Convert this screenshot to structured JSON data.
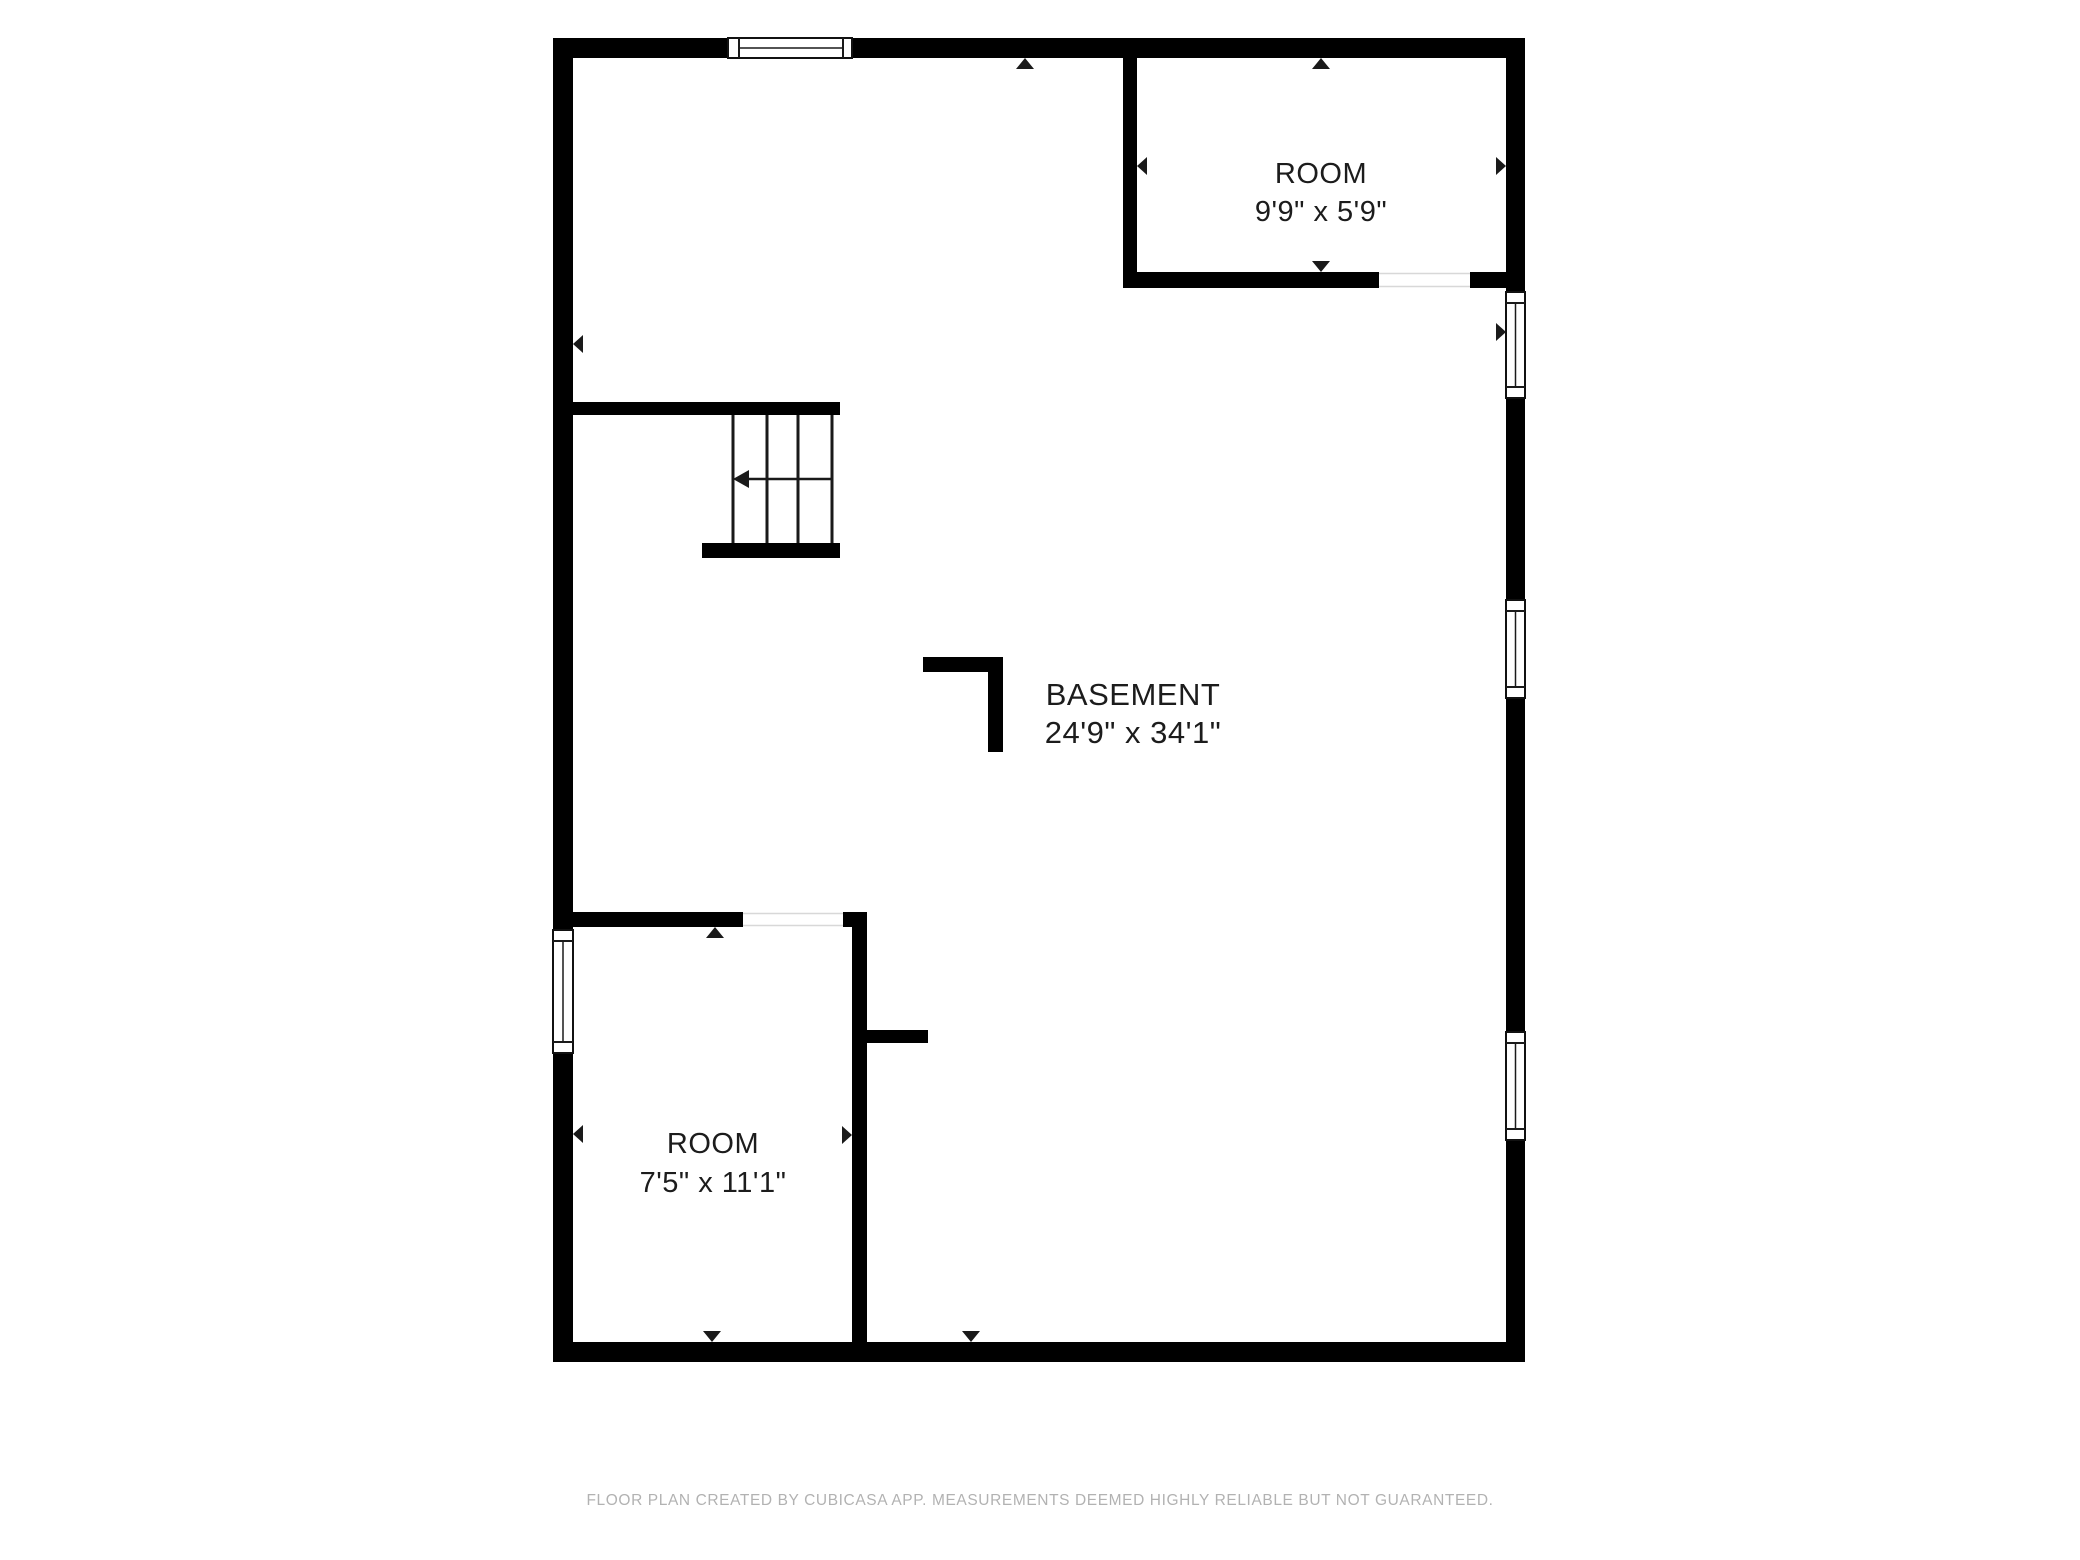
{
  "canvas": {
    "width": 2080,
    "height": 1560,
    "background": "#ffffff"
  },
  "plan": {
    "wall_color": "#000000",
    "line_color": "#1a1a1a",
    "text_color": "#1c1c1c",
    "opening_edge_color": "#d8d8d8",
    "rooms": [
      {
        "label": "ROOM",
        "dimensions": "9'9\" x 5'9\""
      },
      {
        "label": "BASEMENT",
        "dimensions": "24'9\" x 34'1\""
      },
      {
        "label": "ROOM",
        "dimensions": "7'5\" x 11'1\""
      }
    ],
    "shapes": [
      {
        "type": "rect",
        "x": 553,
        "y": 38,
        "w": 175,
        "h": 20,
        "name": "wall-top-left-segment"
      },
      {
        "type": "rect",
        "x": 852,
        "y": 38,
        "w": 673,
        "h": 20,
        "name": "wall-top-right-segment"
      },
      {
        "type": "rect",
        "x": 553,
        "y": 58,
        "w": 20,
        "h": 872,
        "name": "wall-left-upper-segment"
      },
      {
        "type": "rect",
        "x": 553,
        "y": 1053,
        "w": 20,
        "h": 309,
        "name": "wall-left-lower-segment"
      },
      {
        "type": "rect",
        "x": 1506,
        "y": 58,
        "w": 19,
        "h": 234,
        "name": "wall-right-segment-1"
      },
      {
        "type": "rect",
        "x": 1506,
        "y": 398,
        "w": 19,
        "h": 202,
        "name": "wall-right-segment-2"
      },
      {
        "type": "rect",
        "x": 1506,
        "y": 698,
        "w": 19,
        "h": 334,
        "name": "wall-right-segment-3"
      },
      {
        "type": "rect",
        "x": 1506,
        "y": 1140,
        "w": 19,
        "h": 222,
        "name": "wall-right-segment-4"
      },
      {
        "type": "rect",
        "x": 553,
        "y": 1342,
        "w": 972,
        "h": 20,
        "name": "wall-bottom"
      },
      {
        "type": "rect",
        "x": 573,
        "y": 402,
        "w": 267,
        "h": 13,
        "name": "wall-stair-header"
      },
      {
        "type": "rect",
        "x": 702,
        "y": 543,
        "w": 138,
        "h": 15,
        "name": "stair-base-wall"
      },
      {
        "type": "rect",
        "x": 573,
        "y": 912,
        "w": 170,
        "h": 15,
        "name": "wall-room1-top"
      },
      {
        "type": "rect",
        "x": 843,
        "y": 912,
        "w": 24,
        "h": 15,
        "name": "wall-room1-top-corner"
      },
      {
        "type": "rect",
        "x": 852,
        "y": 927,
        "w": 15,
        "h": 415,
        "name": "wall-room1-right"
      },
      {
        "type": "rect",
        "x": 867,
        "y": 1030,
        "w": 61,
        "h": 13,
        "name": "wall-stub"
      },
      {
        "type": "rect",
        "x": 1123,
        "y": 57,
        "w": 14,
        "h": 215,
        "name": "wall-room2-left"
      },
      {
        "type": "rect",
        "x": 1123,
        "y": 272,
        "w": 256,
        "h": 16,
        "name": "wall-room2-bottom-left-segment"
      },
      {
        "type": "rect",
        "x": 1470,
        "y": 272,
        "w": 36,
        "h": 16,
        "name": "wall-room2-bottom-right-segment"
      },
      {
        "type": "rect",
        "x": 923,
        "y": 657,
        "w": 80,
        "h": 15,
        "name": "corner-marker-horizontal"
      },
      {
        "type": "rect",
        "x": 988,
        "y": 657,
        "w": 15,
        "h": 95,
        "name": "corner-marker-vertical"
      },
      {
        "type": "rect",
        "x": 743,
        "y": 912,
        "w": 100,
        "h": 15,
        "fill": "#ffffff",
        "name": "doorway-opening"
      },
      {
        "type": "line",
        "x1": 743,
        "y1": 913.5,
        "x2": 843,
        "y2": 913.5,
        "sw": 1.5,
        "color": "#d8d8d8",
        "name": "doorway-opening-edge"
      },
      {
        "type": "line",
        "x1": 743,
        "y1": 925.5,
        "x2": 843,
        "y2": 925.5,
        "sw": 1.5,
        "color": "#d8d8d8",
        "name": "doorway-opening-edge"
      },
      {
        "type": "rect",
        "x": 1379,
        "y": 272,
        "w": 91,
        "h": 16,
        "fill": "#ffffff",
        "name": "doorway-opening"
      },
      {
        "type": "line",
        "x1": 1379,
        "y1": 273.5,
        "x2": 1470,
        "y2": 273.5,
        "sw": 1.5,
        "color": "#d8d8d8",
        "name": "doorway-opening-edge"
      },
      {
        "type": "line",
        "x1": 1379,
        "y1": 286.5,
        "x2": 1470,
        "y2": 286.5,
        "sw": 1.5,
        "color": "#d8d8d8",
        "name": "doorway-opening-edge"
      },
      {
        "type": "rect",
        "x": 728,
        "y": 38,
        "w": 124,
        "h": 20,
        "fill": "#ffffff",
        "stroke": "#111111",
        "sw": 2,
        "name": "window-frame"
      },
      {
        "type": "line",
        "x1": 739,
        "y1": 38,
        "x2": 739,
        "y2": 58,
        "sw": 2,
        "name": "window-frame-line"
      },
      {
        "type": "line",
        "x1": 843,
        "y1": 38,
        "x2": 843,
        "y2": 58,
        "sw": 2,
        "name": "window-frame-line"
      },
      {
        "type": "line",
        "x1": 739,
        "y1": 48,
        "x2": 843,
        "y2": 48,
        "sw": 1.5,
        "name": "window-pane-line"
      },
      {
        "type": "rect",
        "x": 553,
        "y": 930,
        "w": 20,
        "h": 123,
        "fill": "#ffffff",
        "stroke": "#111111",
        "sw": 2,
        "name": "window-frame"
      },
      {
        "type": "line",
        "x1": 553,
        "y1": 941,
        "x2": 573,
        "y2": 941,
        "sw": 2,
        "name": "window-frame-line"
      },
      {
        "type": "line",
        "x1": 553,
        "y1": 1042,
        "x2": 573,
        "y2": 1042,
        "sw": 2,
        "name": "window-frame-line"
      },
      {
        "type": "line",
        "x1": 563,
        "y1": 941,
        "x2": 563,
        "y2": 1042,
        "sw": 1.5,
        "name": "window-pane-line"
      },
      {
        "type": "rect",
        "x": 1506,
        "y": 292,
        "w": 19,
        "h": 106,
        "fill": "#ffffff",
        "stroke": "#111111",
        "sw": 2,
        "name": "window-frame"
      },
      {
        "type": "line",
        "x1": 1506,
        "y1": 303,
        "x2": 1525,
        "y2": 303,
        "sw": 2,
        "name": "window-frame-line"
      },
      {
        "type": "line",
        "x1": 1506,
        "y1": 387,
        "x2": 1525,
        "y2": 387,
        "sw": 2,
        "name": "window-frame-line"
      },
      {
        "type": "line",
        "x1": 1515.5,
        "y1": 303,
        "x2": 1515.5,
        "y2": 387,
        "sw": 1.5,
        "name": "window-pane-line"
      },
      {
        "type": "rect",
        "x": 1506,
        "y": 600,
        "w": 19,
        "h": 98,
        "fill": "#ffffff",
        "stroke": "#111111",
        "sw": 2,
        "name": "window-frame"
      },
      {
        "type": "line",
        "x1": 1506,
        "y1": 611,
        "x2": 1525,
        "y2": 611,
        "sw": 2,
        "name": "window-frame-line"
      },
      {
        "type": "line",
        "x1": 1506,
        "y1": 687,
        "x2": 1525,
        "y2": 687,
        "sw": 2,
        "name": "window-frame-line"
      },
      {
        "type": "line",
        "x1": 1515.5,
        "y1": 611,
        "x2": 1515.5,
        "y2": 687,
        "sw": 1.5,
        "name": "window-pane-line"
      },
      {
        "type": "rect",
        "x": 1506,
        "y": 1032,
        "w": 19,
        "h": 108,
        "fill": "#ffffff",
        "stroke": "#111111",
        "sw": 2,
        "name": "window-frame"
      },
      {
        "type": "line",
        "x1": 1506,
        "y1": 1043,
        "x2": 1525,
        "y2": 1043,
        "sw": 2,
        "name": "window-frame-line"
      },
      {
        "type": "line",
        "x1": 1506,
        "y1": 1129,
        "x2": 1525,
        "y2": 1129,
        "sw": 2,
        "name": "window-frame-line"
      },
      {
        "type": "line",
        "x1": 1515.5,
        "y1": 1043,
        "x2": 1515.5,
        "y2": 1129,
        "sw": 1.5,
        "name": "window-pane-line"
      },
      {
        "type": "line",
        "x1": 733,
        "y1": 415,
        "x2": 733,
        "y2": 543,
        "sw": 3,
        "name": "stair-tread-line"
      },
      {
        "type": "line",
        "x1": 767,
        "y1": 415,
        "x2": 767,
        "y2": 543,
        "sw": 3,
        "name": "stair-tread-line"
      },
      {
        "type": "line",
        "x1": 798,
        "y1": 415,
        "x2": 798,
        "y2": 543,
        "sw": 3,
        "name": "stair-tread-line"
      },
      {
        "type": "line",
        "x1": 832,
        "y1": 415,
        "x2": 832,
        "y2": 543,
        "sw": 3,
        "name": "stair-tread-line"
      },
      {
        "type": "line",
        "x1": 747,
        "y1": 479,
        "x2": 832,
        "y2": 479,
        "sw": 2.5,
        "name": "stair-arrow-line"
      },
      {
        "type": "poly",
        "points": [
          [
            733,
            479
          ],
          [
            749,
            470
          ],
          [
            749,
            488
          ]
        ],
        "name": "stair-direction-arrow"
      },
      {
        "type": "poly",
        "points": [
          [
            1025,
            58
          ],
          [
            1016,
            69
          ],
          [
            1034,
            69
          ]
        ],
        "name": "wall-marker-arrow-up"
      },
      {
        "type": "poly",
        "points": [
          [
            573,
            344
          ],
          [
            583,
            335
          ],
          [
            583,
            353
          ]
        ],
        "name": "wall-marker-arrow-left"
      },
      {
        "type": "poly",
        "points": [
          [
            1321,
            58
          ],
          [
            1312,
            69
          ],
          [
            1330,
            69
          ]
        ],
        "name": "wall-marker-arrow-up"
      },
      {
        "type": "poly",
        "points": [
          [
            1137,
            166
          ],
          [
            1147,
            157
          ],
          [
            1147,
            175
          ]
        ],
        "name": "wall-marker-arrow-left"
      },
      {
        "type": "poly",
        "points": [
          [
            1506,
            166
          ],
          [
            1496,
            157
          ],
          [
            1496,
            175
          ]
        ],
        "name": "wall-marker-arrow-right"
      },
      {
        "type": "poly",
        "points": [
          [
            1321,
            272
          ],
          [
            1312,
            261
          ],
          [
            1330,
            261
          ]
        ],
        "name": "wall-marker-arrow-down"
      },
      {
        "type": "poly",
        "points": [
          [
            1506,
            332
          ],
          [
            1496,
            323
          ],
          [
            1496,
            341
          ]
        ],
        "name": "wall-marker-arrow-right"
      },
      {
        "type": "poly",
        "points": [
          [
            715,
            927
          ],
          [
            706,
            938
          ],
          [
            724,
            938
          ]
        ],
        "name": "wall-marker-arrow-up"
      },
      {
        "type": "poly",
        "points": [
          [
            573,
            1134
          ],
          [
            583,
            1125
          ],
          [
            583,
            1143
          ]
        ],
        "name": "wall-marker-arrow-left"
      },
      {
        "type": "poly",
        "points": [
          [
            852,
            1135
          ],
          [
            842,
            1126
          ],
          [
            842,
            1144
          ]
        ],
        "name": "wall-marker-arrow-right"
      },
      {
        "type": "poly",
        "points": [
          [
            712,
            1342
          ],
          [
            703,
            1331
          ],
          [
            721,
            1331
          ]
        ],
        "name": "wall-marker-arrow-down"
      },
      {
        "type": "poly",
        "points": [
          [
            971,
            1342
          ],
          [
            962,
            1331
          ],
          [
            980,
            1331
          ]
        ],
        "name": "wall-marker-arrow-down"
      },
      {
        "type": "text",
        "x": 1321,
        "y": 173,
        "fs": 29,
        "text": "ROOM",
        "name": "room-label"
      },
      {
        "type": "text",
        "x": 1321,
        "y": 211,
        "fs": 29,
        "text": "9'9\" x 5'9\"",
        "name": "room-dimensions"
      },
      {
        "type": "text",
        "x": 1133,
        "y": 694,
        "fs": 31,
        "text": "BASEMENT",
        "name": "room-label"
      },
      {
        "type": "text",
        "x": 1133,
        "y": 732,
        "fs": 31,
        "text": "24'9\" x 34'1\"",
        "name": "room-dimensions"
      },
      {
        "type": "text",
        "x": 713,
        "y": 1143,
        "fs": 29,
        "text": "ROOM",
        "name": "room-label"
      },
      {
        "type": "text",
        "x": 713,
        "y": 1182,
        "fs": 29,
        "text": "7'5\" x 11'1\"",
        "name": "room-dimensions"
      }
    ]
  },
  "footer": {
    "text": "FLOOR PLAN CREATED BY CUBICASA APP. MEASUREMENTS DEEMED HIGHLY RELIABLE BUT NOT GUARANTEED.",
    "color": "#b2b2b2"
  }
}
